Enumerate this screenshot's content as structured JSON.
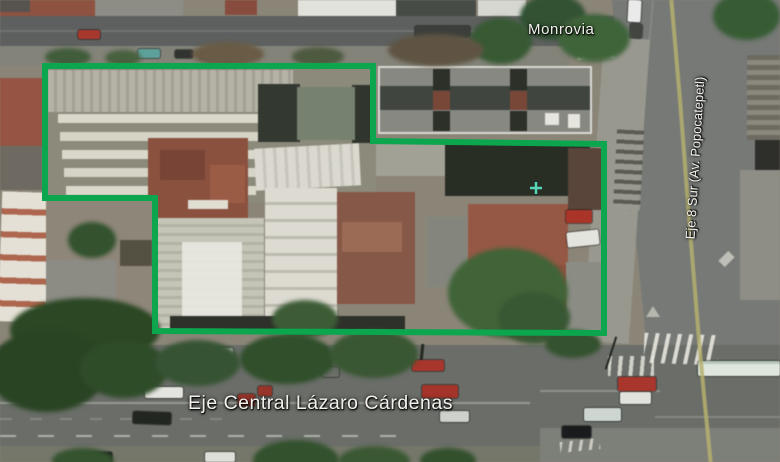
{
  "map": {
    "labels": {
      "top_street": "Monrovia",
      "bottom_street": "Eje Central Lázaro Cárdenas",
      "right_street": "Eje 8 Sur (Av. Popocatepetl)",
      "label_color": "#f2f1ec"
    },
    "boundary": {
      "color": "#0ba64e",
      "stroke_width": 6,
      "points": "45,66 373,66 373,141 604,144 604,333 155,331 155,198 45,198"
    },
    "median_line": {
      "color": "#b7b168",
      "points": "671,-4 680,100 690,230 699,340 704,395 711,466"
    },
    "marker": {
      "color": "#5ce8c9"
    }
  }
}
